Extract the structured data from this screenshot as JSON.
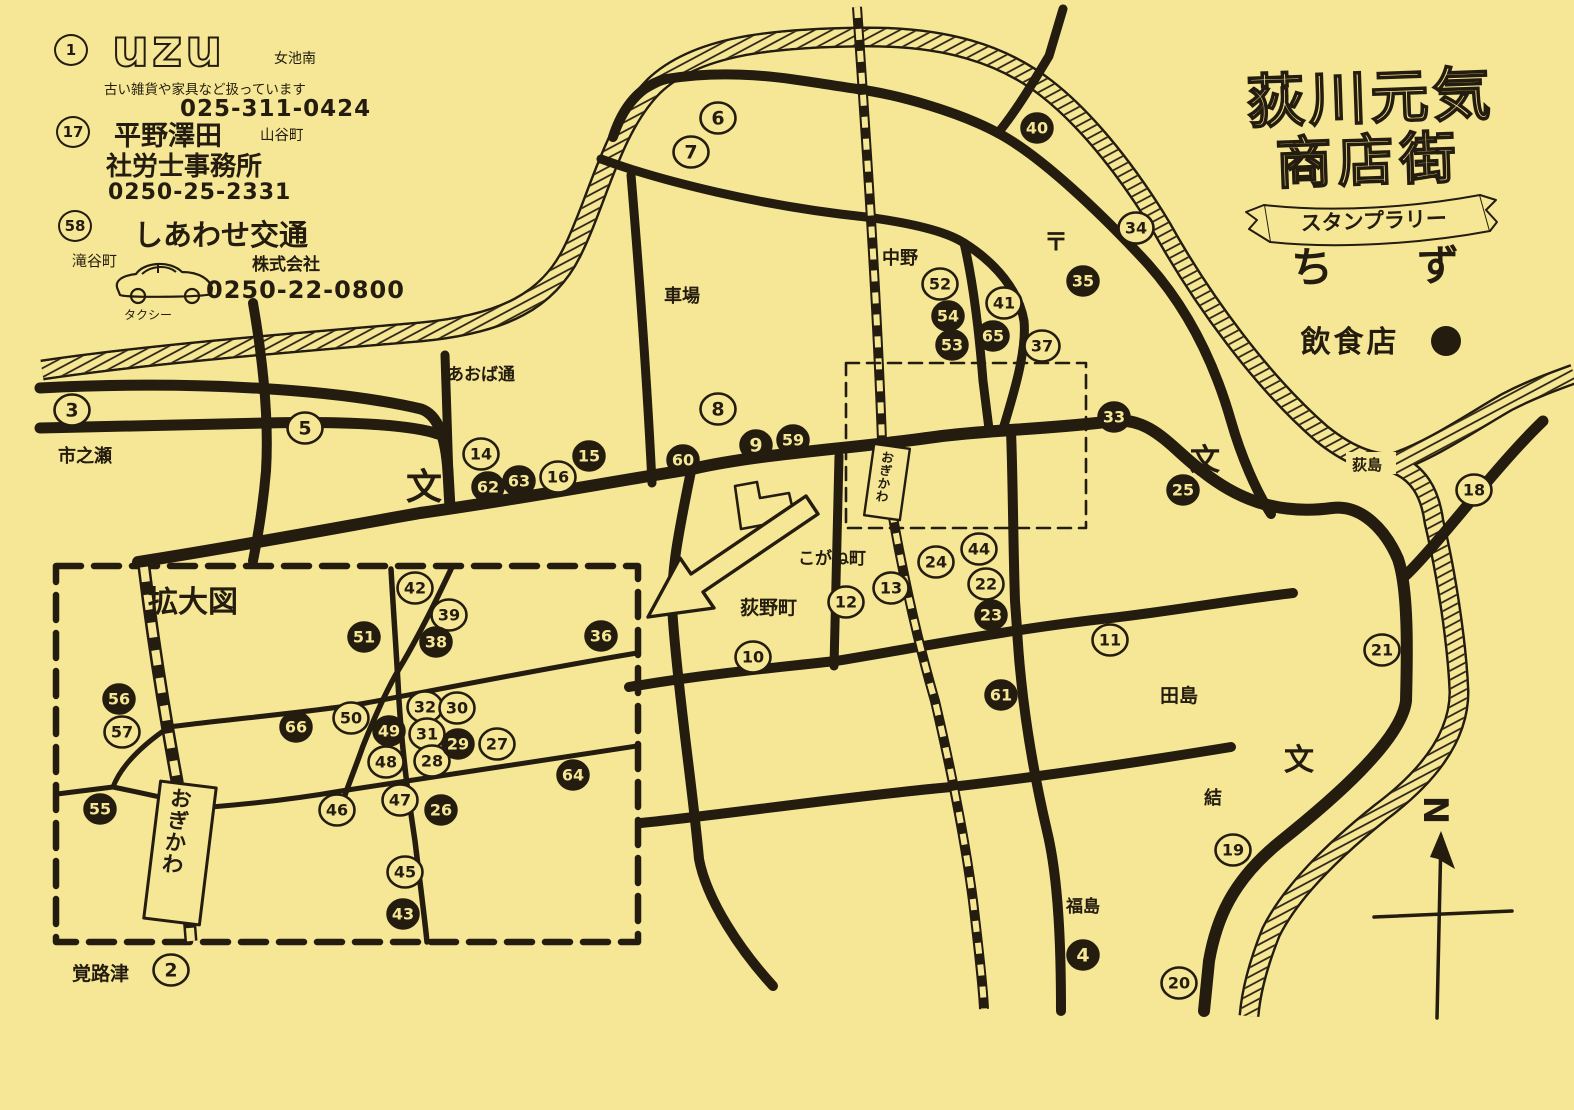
{
  "page": {
    "paper_color": "#f5e795",
    "ink_color": "#241c0e"
  },
  "title": {
    "line1": "荻川元気",
    "line2": "商店街",
    "ribbon": "スタンプラリー",
    "sub1": "ち",
    "sub2": "ず",
    "legend_label": "飲食店",
    "compass_label": "N"
  },
  "ads": [
    {
      "marker": "1",
      "logo": "uzu",
      "area": "女池南",
      "desc": "古い雑貨や家具など扱っています",
      "phone": "025-311-0424"
    },
    {
      "marker": "17",
      "name": "平野澤田",
      "area": "山谷町",
      "name2": "社労士事務所",
      "phone": "0250-25-2331"
    },
    {
      "marker": "58",
      "name": "しあわせ交通",
      "company": "株式会社",
      "area": "滝谷町",
      "vehicle": "タクシー",
      "phone": "0250-22-0800"
    }
  ],
  "map": {
    "labels": [
      {
        "t": "市之瀬",
        "x": 58,
        "y": 462,
        "s": 18
      },
      {
        "t": "あおば通",
        "x": 447,
        "y": 380,
        "s": 17
      },
      {
        "t": "車場",
        "x": 664,
        "y": 302,
        "s": 18
      },
      {
        "t": "中野",
        "x": 882,
        "y": 264,
        "s": 18
      },
      {
        "t": "〒",
        "x": 1044,
        "y": 250,
        "s": 24,
        "b": 1
      },
      {
        "t": "こがね町",
        "x": 798,
        "y": 564,
        "s": 17
      },
      {
        "t": "荻野町",
        "x": 740,
        "y": 614,
        "s": 19
      },
      {
        "t": "田島",
        "x": 1160,
        "y": 702,
        "s": 19
      },
      {
        "t": "結",
        "x": 1204,
        "y": 804,
        "s": 18
      },
      {
        "t": "福島",
        "x": 1066,
        "y": 912,
        "s": 17
      },
      {
        "t": "荻島",
        "x": 1352,
        "y": 470,
        "s": 15
      },
      {
        "t": "覚路津",
        "x": 72,
        "y": 980,
        "s": 19
      },
      {
        "t": "文",
        "x": 406,
        "y": 499,
        "s": 36,
        "b": 1
      },
      {
        "t": "文",
        "x": 1190,
        "y": 470,
        "s": 30,
        "b": 1
      },
      {
        "t": "文",
        "x": 1284,
        "y": 770,
        "s": 30,
        "b": 1
      },
      {
        "t": "おぎかわ",
        "x": 887,
        "y": 462,
        "s": 12.5,
        "v": 1,
        "r": 8
      }
    ],
    "markers": [
      {
        "n": "3",
        "x": 72,
        "y": 410,
        "f": 0
      },
      {
        "n": "5",
        "x": 305,
        "y": 428,
        "f": 0
      },
      {
        "n": "6",
        "x": 718,
        "y": 118,
        "f": 0
      },
      {
        "n": "7",
        "x": 691,
        "y": 152,
        "f": 0
      },
      {
        "n": "8",
        "x": 718,
        "y": 409,
        "f": 0
      },
      {
        "n": "14",
        "x": 481,
        "y": 454,
        "f": 0
      },
      {
        "n": "16",
        "x": 558,
        "y": 477,
        "f": 0
      },
      {
        "n": "34",
        "x": 1136,
        "y": 228,
        "f": 0
      },
      {
        "n": "52",
        "x": 940,
        "y": 284,
        "f": 0
      },
      {
        "n": "41",
        "x": 1004,
        "y": 303,
        "f": 0
      },
      {
        "n": "37",
        "x": 1042,
        "y": 346,
        "f": 0
      },
      {
        "n": "24",
        "x": 936,
        "y": 562,
        "f": 0
      },
      {
        "n": "44",
        "x": 979,
        "y": 549,
        "f": 0
      },
      {
        "n": "22",
        "x": 986,
        "y": 584,
        "f": 0
      },
      {
        "n": "13",
        "x": 891,
        "y": 588,
        "f": 0
      },
      {
        "n": "12",
        "x": 846,
        "y": 602,
        "f": 0
      },
      {
        "n": "10",
        "x": 753,
        "y": 657,
        "f": 0
      },
      {
        "n": "11",
        "x": 1110,
        "y": 640,
        "f": 0
      },
      {
        "n": "18",
        "x": 1474,
        "y": 490,
        "f": 0
      },
      {
        "n": "21",
        "x": 1382,
        "y": 650,
        "f": 0
      },
      {
        "n": "19",
        "x": 1233,
        "y": 850,
        "f": 0
      },
      {
        "n": "20",
        "x": 1179,
        "y": 983,
        "f": 0
      },
      {
        "n": "2",
        "x": 171,
        "y": 970,
        "f": 0
      },
      {
        "n": "40",
        "x": 1037,
        "y": 128,
        "f": 1
      },
      {
        "n": "35",
        "x": 1083,
        "y": 281,
        "f": 1
      },
      {
        "n": "54",
        "x": 948,
        "y": 316,
        "f": 1
      },
      {
        "n": "53",
        "x": 952,
        "y": 345,
        "f": 1
      },
      {
        "n": "65",
        "x": 993,
        "y": 336,
        "f": 1
      },
      {
        "n": "33",
        "x": 1114,
        "y": 417,
        "f": 1
      },
      {
        "n": "25",
        "x": 1183,
        "y": 490,
        "f": 1
      },
      {
        "n": "62",
        "x": 488,
        "y": 487,
        "f": 1
      },
      {
        "n": "63",
        "x": 519,
        "y": 481,
        "f": 1
      },
      {
        "n": "15",
        "x": 589,
        "y": 456,
        "f": 1
      },
      {
        "n": "60",
        "x": 683,
        "y": 460,
        "f": 1
      },
      {
        "n": "9",
        "x": 756,
        "y": 445,
        "f": 1
      },
      {
        "n": "59",
        "x": 793,
        "y": 440,
        "f": 1
      },
      {
        "n": "23",
        "x": 991,
        "y": 615,
        "f": 1
      },
      {
        "n": "61",
        "x": 1001,
        "y": 695,
        "f": 1
      },
      {
        "n": "4",
        "x": 1083,
        "y": 955,
        "f": 1
      }
    ]
  },
  "inset": {
    "title": "拡大図",
    "labels": [
      {
        "t": "拡大図",
        "x": 148,
        "y": 612,
        "s": 30,
        "b": 1
      },
      {
        "t": "おぎかわ",
        "x": 180,
        "y": 806,
        "s": 21,
        "v": 1,
        "r": 7
      }
    ],
    "markers": [
      {
        "n": "42",
        "x": 415,
        "y": 588,
        "f": 0
      },
      {
        "n": "39",
        "x": 449,
        "y": 615,
        "f": 0
      },
      {
        "n": "57",
        "x": 122,
        "y": 732,
        "f": 0
      },
      {
        "n": "50",
        "x": 351,
        "y": 718,
        "f": 0
      },
      {
        "n": "32",
        "x": 425,
        "y": 707,
        "f": 0
      },
      {
        "n": "30",
        "x": 457,
        "y": 708,
        "f": 0
      },
      {
        "n": "31",
        "x": 427,
        "y": 734,
        "f": 0
      },
      {
        "n": "27",
        "x": 497,
        "y": 744,
        "f": 0
      },
      {
        "n": "48",
        "x": 386,
        "y": 762,
        "f": 0
      },
      {
        "n": "28",
        "x": 432,
        "y": 761,
        "f": 0
      },
      {
        "n": "46",
        "x": 337,
        "y": 810,
        "f": 0
      },
      {
        "n": "47",
        "x": 400,
        "y": 800,
        "f": 0
      },
      {
        "n": "45",
        "x": 405,
        "y": 872,
        "f": 0
      },
      {
        "n": "51",
        "x": 364,
        "y": 637,
        "f": 1
      },
      {
        "n": "38",
        "x": 436,
        "y": 642,
        "f": 1
      },
      {
        "n": "36",
        "x": 601,
        "y": 636,
        "f": 1
      },
      {
        "n": "56",
        "x": 119,
        "y": 699,
        "f": 1
      },
      {
        "n": "66",
        "x": 296,
        "y": 727,
        "f": 1
      },
      {
        "n": "49",
        "x": 389,
        "y": 731,
        "f": 1
      },
      {
        "n": "29",
        "x": 458,
        "y": 744,
        "f": 1
      },
      {
        "n": "64",
        "x": 573,
        "y": 775,
        "f": 1
      },
      {
        "n": "26",
        "x": 441,
        "y": 810,
        "f": 1
      },
      {
        "n": "43",
        "x": 403,
        "y": 914,
        "f": 1
      },
      {
        "n": "55",
        "x": 100,
        "y": 809,
        "f": 1
      }
    ]
  }
}
